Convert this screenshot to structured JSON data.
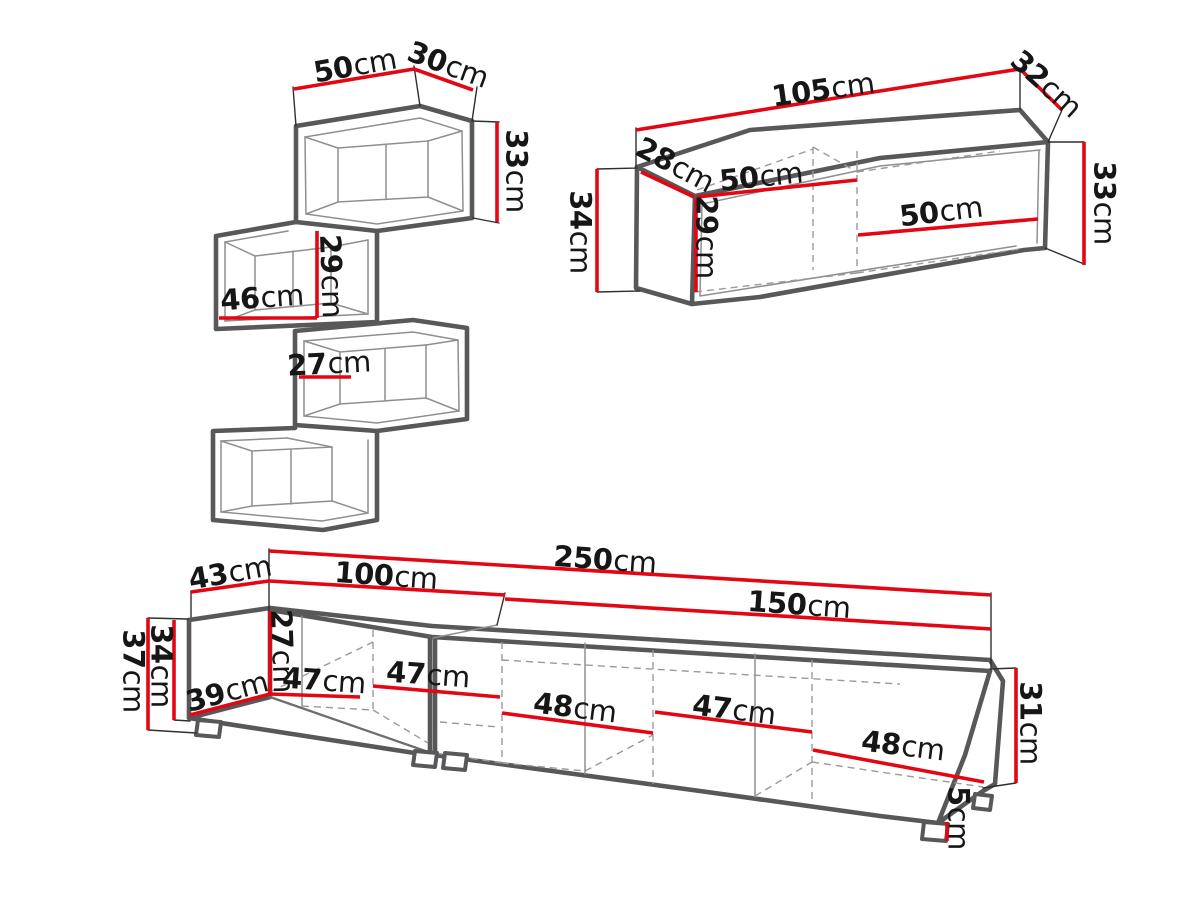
{
  "colors": {
    "dimension_red": "#e30613",
    "outline_gray": "#58585a",
    "hidden_line_gray": "#9a9a9a",
    "label_black": "#161616",
    "background": "#ffffff"
  },
  "shelf": {
    "width": {
      "value": "50",
      "unit": "cm"
    },
    "depth": {
      "value": "30",
      "unit": "cm"
    },
    "height": {
      "value": "33",
      "unit": "cm"
    },
    "inner_height": {
      "value": "29",
      "unit": "cm"
    },
    "inner_width": {
      "value": "46",
      "unit": "cm"
    },
    "upper_inner_width": {
      "value": "27",
      "unit": "cm"
    }
  },
  "cabinet": {
    "width": {
      "value": "105",
      "unit": "cm"
    },
    "depth": {
      "value": "32",
      "unit": "cm"
    },
    "side_depth": {
      "value": "28",
      "unit": "cm"
    },
    "side_height": {
      "value": "34",
      "unit": "cm"
    },
    "inner_height": {
      "value": "29",
      "unit": "cm"
    },
    "inner_width_left": {
      "value": "50",
      "unit": "cm"
    },
    "inner_width_right": {
      "value": "50",
      "unit": "cm"
    },
    "height": {
      "value": "33",
      "unit": "cm"
    }
  },
  "tv_stand": {
    "depth": {
      "value": "43",
      "unit": "cm"
    },
    "left_width": {
      "value": "100",
      "unit": "cm"
    },
    "total_width": {
      "value": "250",
      "unit": "cm"
    },
    "right_width": {
      "value": "150",
      "unit": "cm"
    },
    "height": {
      "value": "37",
      "unit": "cm"
    },
    "side_height": {
      "value": "34",
      "unit": "cm"
    },
    "inner_height": {
      "value": "27",
      "unit": "cm"
    },
    "side_depth": {
      "value": "39",
      "unit": "cm"
    },
    "door1": {
      "value": "47",
      "unit": "cm"
    },
    "door2": {
      "value": "47",
      "unit": "cm"
    },
    "door3": {
      "value": "48",
      "unit": "cm"
    },
    "door4": {
      "value": "47",
      "unit": "cm"
    },
    "door5": {
      "value": "48",
      "unit": "cm"
    },
    "right_height": {
      "value": "31",
      "unit": "cm"
    },
    "leg_height": {
      "value": "5",
      "unit": "cm"
    }
  }
}
